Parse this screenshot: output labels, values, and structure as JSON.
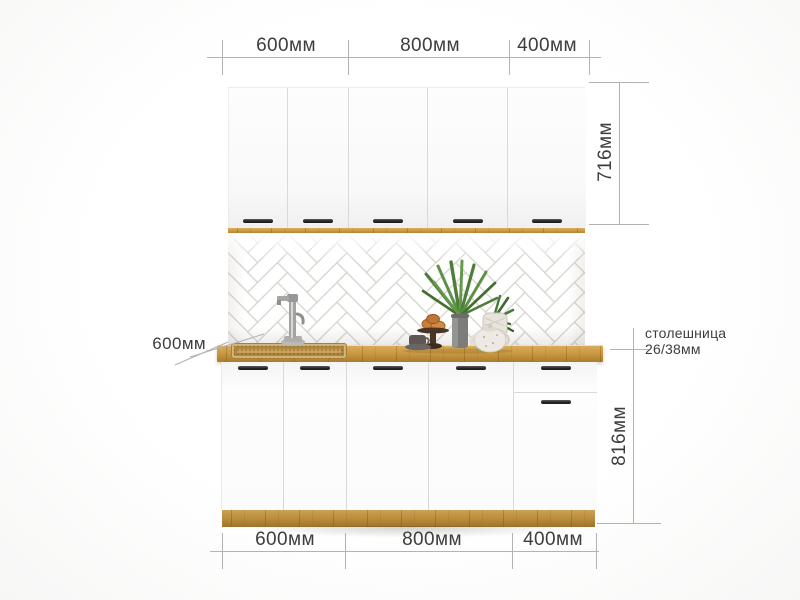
{
  "annotations": {
    "top_widths": [
      "600мм",
      "800мм",
      "400мм"
    ],
    "bottom_widths": [
      "600мм",
      "800мм",
      "400мм"
    ],
    "upper_cabinet_height": "716мм",
    "base_cabinet_height": "816мм",
    "countertop_depth": "600мм",
    "countertop_label_line1": "столешница",
    "countertop_label_line2": "26/38мм"
  },
  "colors": {
    "wood": "#c9983f",
    "wood_light": "#dcae5e",
    "wood_dark": "#aa7c2f",
    "grout": "#d6d3cc",
    "dim_line": "#b2b2b2",
    "text": "#3d3d3d",
    "handle": "#1f1f1f",
    "divider": "#d9d9d9"
  },
  "scene": {
    "upper_door_count": 5,
    "base_door_count": 4,
    "drawer_count": 1
  }
}
